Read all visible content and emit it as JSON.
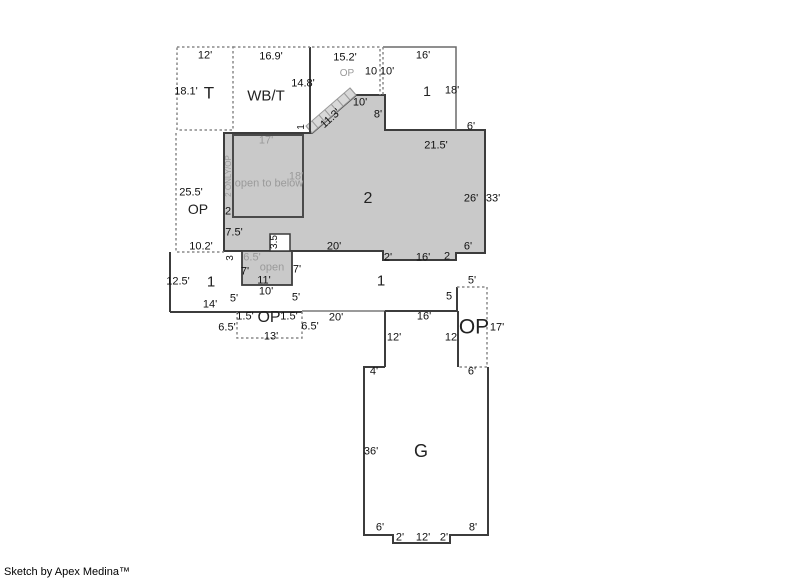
{
  "credit": "Sketch by Apex Medina™",
  "colors": {
    "area_fill": "#c9c9c9",
    "stair_band_fill": "#d8d8d8",
    "wall": "#3c3c3c",
    "dashed_line": "#8a8a8a",
    "light_line": "#9a9a9a",
    "gray_text": "#9a9a9a",
    "black_text": "#111111"
  },
  "plan": {
    "dimensions": [
      {
        "t": "12'",
        "x": 205,
        "y": 56
      },
      {
        "t": "18.1'",
        "x": 186,
        "y": 92
      },
      {
        "t": "16.9'",
        "x": 271,
        "y": 57
      },
      {
        "t": "14.8'",
        "x": 303,
        "y": 84
      },
      {
        "t": "15.2'",
        "x": 345,
        "y": 58
      },
      {
        "t": "10",
        "x": 371,
        "y": 72
      },
      {
        "t": "10'",
        "x": 387,
        "y": 72
      },
      {
        "t": "16'",
        "x": 423,
        "y": 56
      },
      {
        "t": "18'",
        "x": 452,
        "y": 91
      },
      {
        "t": "6'",
        "x": 471,
        "y": 127
      },
      {
        "t": "10'",
        "x": 360,
        "y": 103
      },
      {
        "t": "8'",
        "x": 378,
        "y": 115
      },
      {
        "t": "11.3'",
        "x": 331,
        "y": 119,
        "r": -42
      },
      {
        "t": "1",
        "x": 302,
        "y": 127,
        "r": -90,
        "s": 10
      },
      {
        "t": "21.5'",
        "x": 436,
        "y": 146
      },
      {
        "t": "26'",
        "x": 471,
        "y": 199
      },
      {
        "t": "33'",
        "x": 493,
        "y": 199
      },
      {
        "t": "25.5'",
        "x": 191,
        "y": 193
      },
      {
        "t": "2",
        "x": 228,
        "y": 212
      },
      {
        "t": "10.2'",
        "x": 201,
        "y": 247
      },
      {
        "t": "7.5'",
        "x": 234,
        "y": 233
      },
      {
        "t": "3.5",
        "x": 275,
        "y": 242,
        "r": -90,
        "s": 10
      },
      {
        "t": "3",
        "x": 231,
        "y": 258,
        "r": -90,
        "s": 10
      },
      {
        "t": "7'",
        "x": 245,
        "y": 272
      },
      {
        "t": "7'",
        "x": 297,
        "y": 270
      },
      {
        "t": "11'",
        "x": 264,
        "y": 281
      },
      {
        "t": "20'",
        "x": 334,
        "y": 247
      },
      {
        "t": "2'",
        "x": 388,
        "y": 258
      },
      {
        "t": "16'",
        "x": 423,
        "y": 258
      },
      {
        "t": "2",
        "x": 447,
        "y": 257
      },
      {
        "t": "6'",
        "x": 468,
        "y": 247
      },
      {
        "t": "12.5'",
        "x": 178,
        "y": 282
      },
      {
        "t": "14'",
        "x": 210,
        "y": 305
      },
      {
        "t": "5'",
        "x": 234,
        "y": 299
      },
      {
        "t": "10'",
        "x": 266,
        "y": 292
      },
      {
        "t": "5'",
        "x": 296,
        "y": 298
      },
      {
        "t": "5'",
        "x": 472,
        "y": 281
      },
      {
        "t": "5",
        "x": 449,
        "y": 297
      },
      {
        "t": "1.5'",
        "x": 245,
        "y": 317
      },
      {
        "t": "1.5'",
        "x": 289,
        "y": 317
      },
      {
        "t": "6.5'",
        "x": 227,
        "y": 328
      },
      {
        "t": "6.5'",
        "x": 310,
        "y": 327
      },
      {
        "t": "13'",
        "x": 271,
        "y": 337
      },
      {
        "t": "20'",
        "x": 336,
        "y": 318
      },
      {
        "t": "16'",
        "x": 424,
        "y": 317
      },
      {
        "t": "12'",
        "x": 394,
        "y": 338
      },
      {
        "t": "12",
        "x": 451,
        "y": 338
      },
      {
        "t": "17'",
        "x": 497,
        "y": 328
      },
      {
        "t": "4'",
        "x": 374,
        "y": 372
      },
      {
        "t": "6'",
        "x": 472,
        "y": 372
      },
      {
        "t": "36'",
        "x": 371,
        "y": 452
      },
      {
        "t": "6'",
        "x": 380,
        "y": 528
      },
      {
        "t": "8'",
        "x": 473,
        "y": 528
      },
      {
        "t": "2'",
        "x": 400,
        "y": 538
      },
      {
        "t": "12'",
        "x": 423,
        "y": 538
      },
      {
        "t": "2'",
        "x": 444,
        "y": 538
      }
    ],
    "notes": [
      {
        "t": "OP",
        "x": 347,
        "y": 74,
        "s": 10
      },
      {
        "t": "17'",
        "x": 266,
        "y": 141
      },
      {
        "t": "2 ONLY/OP",
        "x": 229,
        "y": 176,
        "r": -90,
        "s": 8
      },
      {
        "t": "18'",
        "x": 296,
        "y": 177
      },
      {
        "t": "open to below",
        "x": 269,
        "y": 184
      },
      {
        "t": "6.5'",
        "x": 252,
        "y": 258
      },
      {
        "t": "open",
        "x": 272,
        "y": 268
      }
    ],
    "rooms": [
      {
        "t": "T",
        "x": 209,
        "y": 93,
        "s": 17
      },
      {
        "t": "WB/T",
        "x": 266,
        "y": 96,
        "s": 15
      },
      {
        "t": "1",
        "x": 427,
        "y": 91,
        "s": 14
      },
      {
        "t": "2",
        "x": 368,
        "y": 199,
        "s": 16
      },
      {
        "t": "OP",
        "x": 198,
        "y": 209,
        "s": 14
      },
      {
        "t": "1",
        "x": 211,
        "y": 282,
        "s": 15
      },
      {
        "t": "1",
        "x": 381,
        "y": 281,
        "s": 15
      },
      {
        "t": "OP",
        "x": 269,
        "y": 318,
        "s": 16
      },
      {
        "t": "OP",
        "x": 474,
        "y": 327,
        "s": 21
      },
      {
        "t": "G",
        "x": 421,
        "y": 451,
        "s": 18
      }
    ]
  }
}
